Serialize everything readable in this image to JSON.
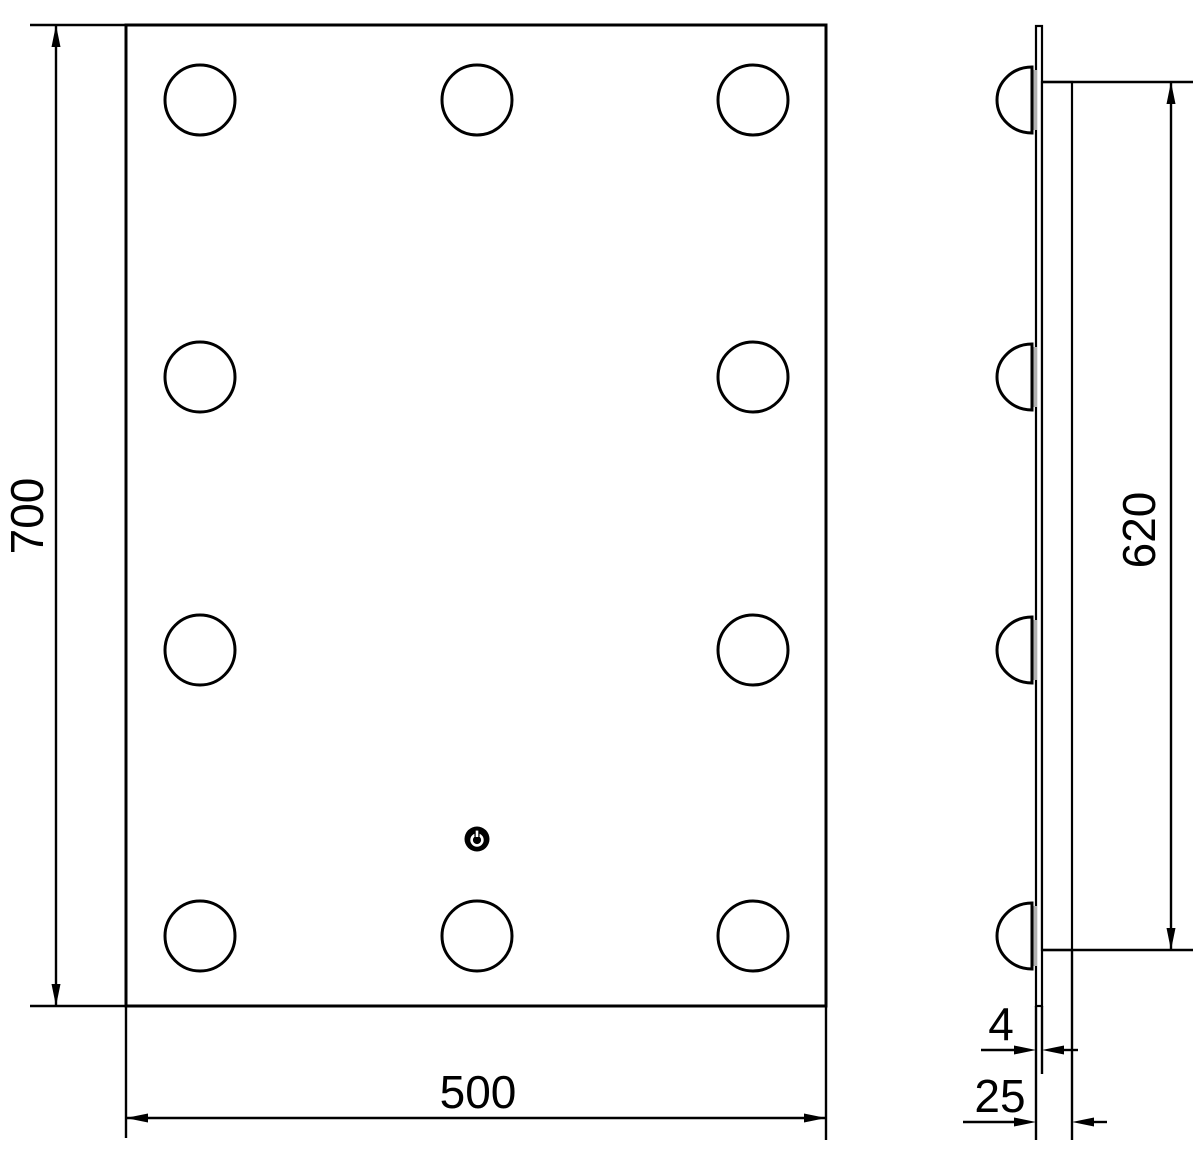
{
  "drawing": {
    "kind": "technical-dimension-drawing",
    "colors": {
      "line": "#000000",
      "background": "#ffffff",
      "led_base_strip": "#b0b0b0"
    },
    "icons": {
      "touch_sensor": "power-touch-sensor-icon",
      "light_bulb": "led-bulb-circle"
    },
    "dimensions": {
      "height_mm": "700",
      "width_mm": "500",
      "led_span_mm": "620",
      "glass_thickness_mm": "4",
      "depth_mm": "25"
    }
  }
}
